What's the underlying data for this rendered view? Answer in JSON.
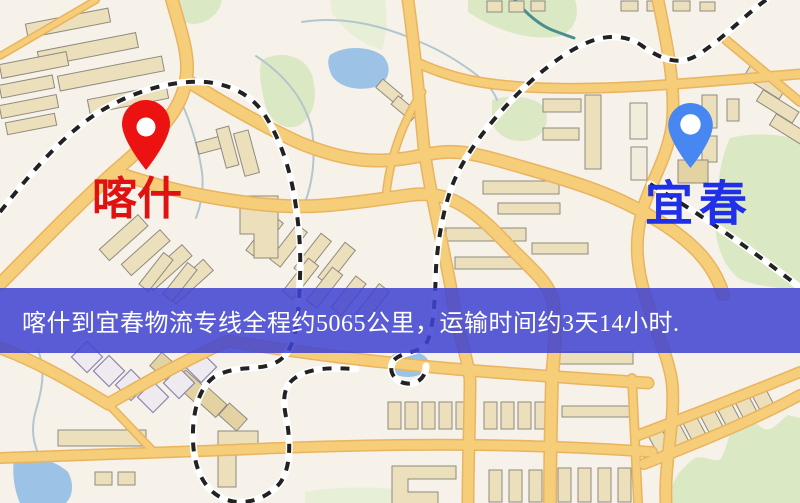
{
  "type": "logistics-route-map",
  "banner": {
    "text": "喀什到宜春物流专线全程约5065公里，运输时间约3天14小时.",
    "background": "rgba(64, 68, 210, 0.86)",
    "text_color": "#ffffff"
  },
  "markers": {
    "origin": {
      "name": "喀什",
      "pin_icon": "map-pin",
      "pin_color": "#ed1212",
      "pin_hole_color": "#ffffff",
      "label_color": "#e01111"
    },
    "destination": {
      "name": "宜春",
      "pin_icon": "map-pin",
      "pin_color": "#4687f2",
      "pin_hole_color": "#ffffff",
      "label_color": "#2030e8"
    }
  },
  "map": {
    "palette": {
      "background": "#f6f1e9",
      "road": "#f6cd79",
      "road-edge": "#e9b45f",
      "park": "#dbe8c4",
      "park-pale": "#e7efd6",
      "water": "#9cc3e5",
      "stream": "#b3c6cd",
      "railway": "#222222",
      "railway-band": "#ffffff",
      "building": "#ece0bc",
      "building-edge": "#8f8a80",
      "building-alt": "#e4d3a2",
      "diamond-edge": "#8a86ac"
    }
  }
}
